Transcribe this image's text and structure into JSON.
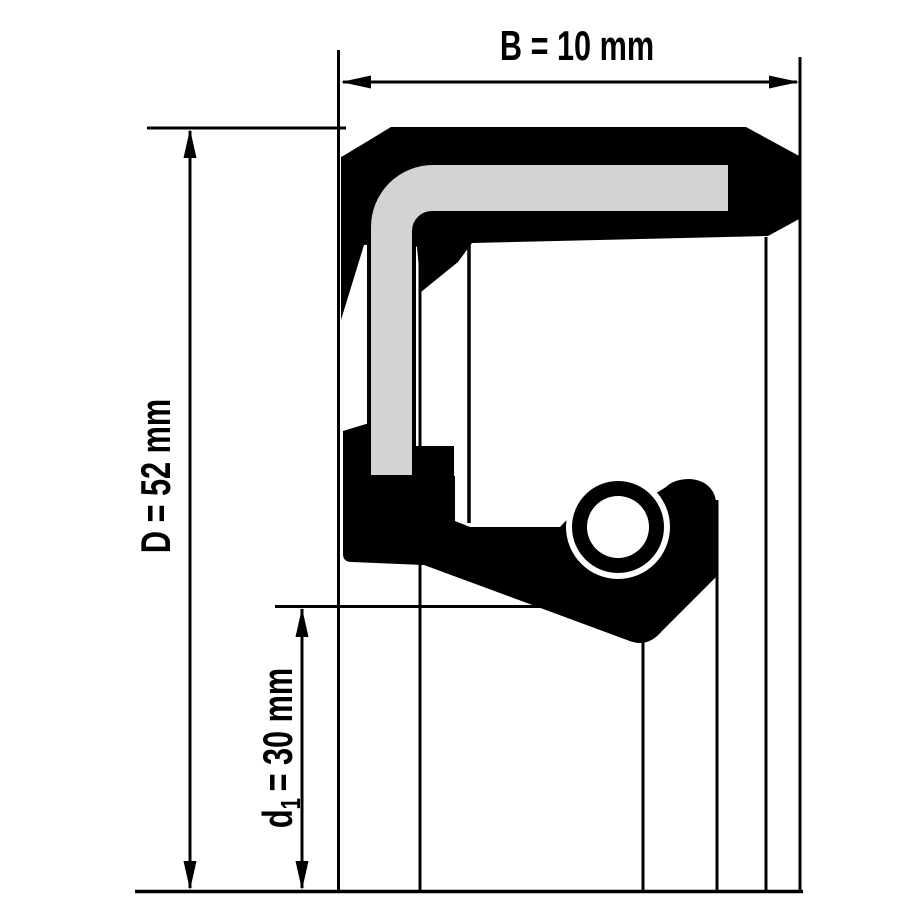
{
  "colors": {
    "background": "#ffffff",
    "line": "#000000",
    "insert_gray": "#d3d3d3"
  },
  "dimensions": {
    "width": {
      "label": "B = 10 mm"
    },
    "outer_diameter": {
      "label": "D = 52 mm"
    },
    "inner_diameter": {
      "prefix": "d",
      "subscript": "1",
      "suffix": "= 30 mm"
    }
  }
}
